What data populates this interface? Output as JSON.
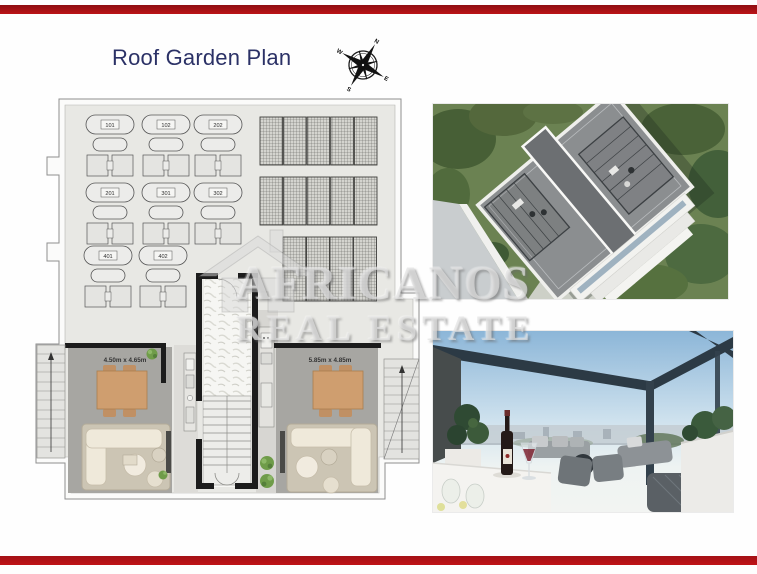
{
  "header": {
    "title": "Roof Garden Plan"
  },
  "compass": {
    "n": "N",
    "e": "E",
    "s": "S",
    "w": "W"
  },
  "plan": {
    "lounger_labels": [
      "101",
      "102",
      "202",
      "201",
      "301",
      "302",
      "401",
      "402"
    ],
    "room_left_dimensions": "4.50m x 4.65m",
    "room_right_dimensions": "5.85m x 4.85m"
  },
  "watermark": {
    "line1": "AFRICANOS",
    "line2": "REAL ESTATE"
  },
  "colors": {
    "accent_red": "#b01215",
    "title_navy": "#2b3166"
  }
}
